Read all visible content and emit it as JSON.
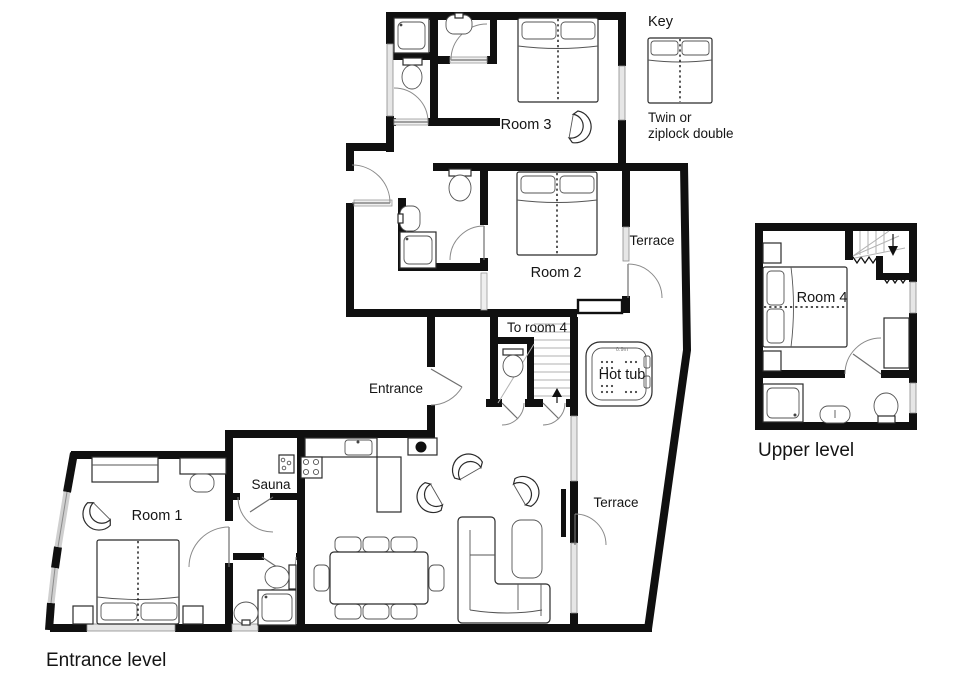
{
  "document": {
    "type": "floor-plan",
    "background": "#ffffff"
  },
  "levels": {
    "entrance": {
      "label": "Entrance level"
    },
    "upper": {
      "label": "Upper level"
    }
  },
  "rooms": {
    "room1": {
      "label": "Room 1"
    },
    "room2": {
      "label": "Room 2"
    },
    "room3": {
      "label": "Room 3"
    },
    "room4": {
      "label": "Room 4"
    },
    "sauna": {
      "label": "Sauna"
    },
    "entrance_area": {
      "label": "Entrance"
    },
    "to_room4": {
      "label": "To room 4"
    },
    "hot_tub": {
      "label": "Hot tub",
      "depth_note": "0.9m"
    },
    "terrace_upper": {
      "label": "Terrace"
    },
    "terrace_lower": {
      "label": "Terrace"
    }
  },
  "key": {
    "title": "Key",
    "caption_line1": "Twin or",
    "caption_line2": "ziplock double"
  },
  "colors": {
    "wall": "#101010",
    "window_fill": "#e6e6e6",
    "window_stroke": "#8c8c8c",
    "furniture_outline": "#2b2b2b",
    "stair_tread": "#b2b2b2",
    "text": "#141414",
    "background": "#ffffff"
  }
}
